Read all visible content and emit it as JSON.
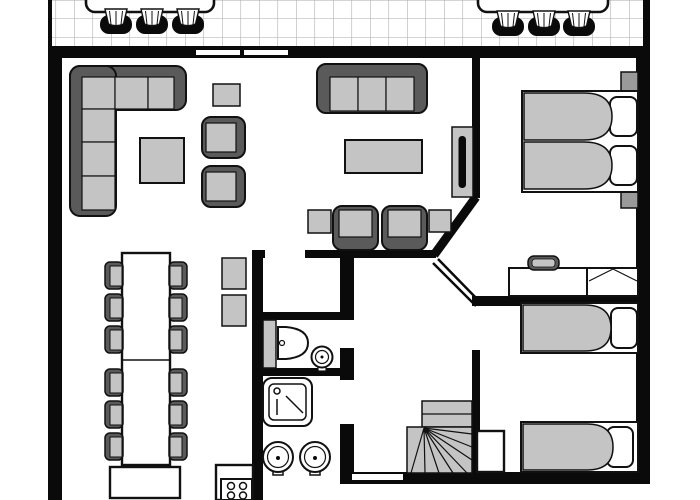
{
  "meta": {
    "description": "Black and white architectural floor plan of a holiday bungalow, top-down view, no text labels"
  },
  "colors": {
    "wall": "#0a0a0a",
    "outline": "#111111",
    "furniture_dark": "#5a5a5a",
    "furniture_light": "#c4c4c4",
    "furniture_mid": "#9a9a9a",
    "grid_line": "#aaaaaa",
    "background": "#ffffff"
  },
  "terrace": {
    "floor": "square-tile-grid",
    "tables": 2,
    "chairs_per_table": 3
  },
  "openings": {
    "top_wall_windows": 2,
    "bottom_wall_windows": 1,
    "interior_door_gaps": 4
  },
  "rooms": [
    {
      "name": "living-room",
      "furniture": [
        "corner-sofa-6-cushions",
        "coffee-table",
        "stool",
        "armchair",
        "armchair",
        "sofa-3-cushions",
        "coffee-table",
        "armchair",
        "armchair",
        "side-table",
        "side-table",
        "tv-on-stand"
      ]
    },
    {
      "name": "dining-area",
      "furniture": [
        "long-dining-table-2-sections",
        "dining-chair-x12",
        "bench",
        "serving-table",
        "serving-table"
      ]
    },
    {
      "name": "kitchen",
      "furniture": [
        "counter",
        "stove-4-burners"
      ]
    },
    {
      "name": "toilet-room",
      "furniture": [
        "toilet",
        "corner-washbasin"
      ]
    },
    {
      "name": "bathroom",
      "furniture": [
        "shower",
        "washbasin",
        "washbasin"
      ]
    },
    {
      "name": "hallway",
      "furniture": [
        "winder-staircase"
      ]
    },
    {
      "name": "bedroom-1",
      "furniture": [
        "double-bed-2-mattresses",
        "pillow",
        "pillow",
        "nightstand",
        "nightstand",
        "desk",
        "desk-chair",
        "open-wardrobe"
      ]
    },
    {
      "name": "bedroom-2",
      "furniture": [
        "single-bed",
        "single-bed",
        "pillow",
        "pillow",
        "closet"
      ]
    }
  ]
}
